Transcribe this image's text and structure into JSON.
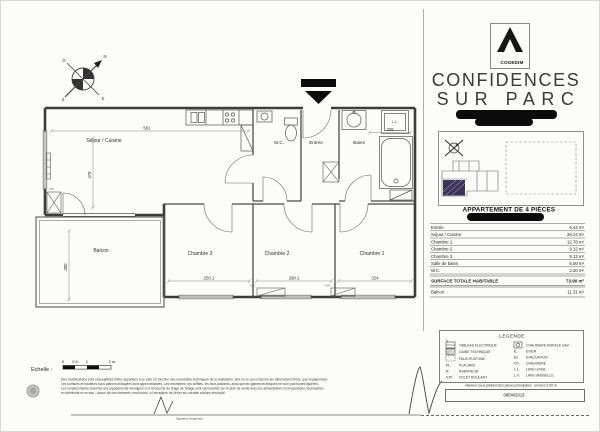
{
  "branding": {
    "logo_name": "COGEDIM",
    "title_line1": "CONFIDENCES",
    "title_line2": "SUR PARC",
    "apartment_type": "APPARTEMENT DE 4 PIÈCES"
  },
  "plan": {
    "rooms": {
      "sejour": "Séjour / Cuisine",
      "wc": "W.C.",
      "entree": "Entrée",
      "bains": "Bains",
      "chambre3": "Chambre 3",
      "chambre2": "Chambre 2",
      "chambre1": "Chambre 1",
      "balcon": "Balcon"
    },
    "fixture_labels": {
      "ll": "L.L.",
      "vr": "V.R."
    },
    "dimensions": {
      "sejour_w": "591",
      "sejour_h": "478",
      "bains_w": "208",
      "ch3_w": "250.1",
      "ch2_w": "298.1",
      "ch1_w": "324",
      "balcon_h": "300"
    },
    "compass": {
      "n": "N",
      "s": "S",
      "e": "E",
      "o": "O"
    }
  },
  "areas": {
    "rows": [
      {
        "label": "Entrée",
        "value": "6.44 m²"
      },
      {
        "label": "Séjour / Cuisine",
        "value": "28.24 m²"
      },
      {
        "label": "Chambre 1",
        "value": "12.78 m²"
      },
      {
        "label": "Chambre 2",
        "value": "9.12 m²"
      },
      {
        "label": "Chambre 3",
        "value": "9.12 m²"
      },
      {
        "label": "Salle de bains",
        "value": "6.00 m²"
      },
      {
        "label": "W.C.",
        "value": "2.20 m²"
      }
    ],
    "total_label": "SURFACE TOTALE HABITABLE",
    "total_value": "73.90 m²",
    "balcony_label": "Balcon",
    "balcony_value": "11.31 m²"
  },
  "legend": {
    "title": "LEGENDE",
    "left": [
      {
        "abbr": "",
        "label": "TABLEAU ELECTRIQUE"
      },
      {
        "abbr": "",
        "label": "GAINE TECHNIQUE"
      },
      {
        "abbr": "",
        "label": "FAUX-PLAFOND"
      },
      {
        "abbr": "PL.",
        "label": "PLACARD"
      },
      {
        "abbr": "R.",
        "label": "RADIATEUR"
      },
      {
        "abbr": "V.R.",
        "label": "VOLET ROULANT"
      }
    ],
    "right": [
      {
        "abbr": "",
        "label": "CHAUDIERE MURALE GAZ"
      },
      {
        "abbr": "E.",
        "label": "EVIER"
      },
      {
        "abbr": "Ev.",
        "label": "EVACUATION"
      },
      {
        "abbr": "Ch.",
        "label": "CHAUDIERE"
      },
      {
        "abbr": "L.L.",
        "label": "LAVE-LINGE"
      },
      {
        "abbr": "L.V.",
        "label": "LAVE-VAISSELLE"
      }
    ],
    "note": "Hauteur sous plafond des pièces principales : environ 2,50 m"
  },
  "footer": {
    "scale_label": "Echelle :",
    "scale_ticks": [
      "0",
      "0.5",
      "1",
      "2 m"
    ],
    "date": "08/04/2013",
    "signature_caption": "Signature acquéreur",
    "disclaimer_lines": [
      "Des modifications sont susceptibles d'être apportées à ce plan en fonction des nécessités techniques de la réalisation, tant en ce qui concerne les dimensions libres, que l'équipement.",
      "Les surfaces et hauteurs sous plafond indiquées sont approximatives. Les retombées, les soffites, les faux-plafonds, ainsi que les gaines techniques ne sont pas toutes figurées.",
      "Les emplacements réservés aux équipements ménagers et à la bouche de tirage de l'étage sont représentés sur le plan de vente avec les alimentations et évacuations nécessaires",
      "en électricité et en eau ; aucun de ces éléments n'est fourni, à l'exception de l'évier sur meuble suivant descriptif."
    ]
  }
}
